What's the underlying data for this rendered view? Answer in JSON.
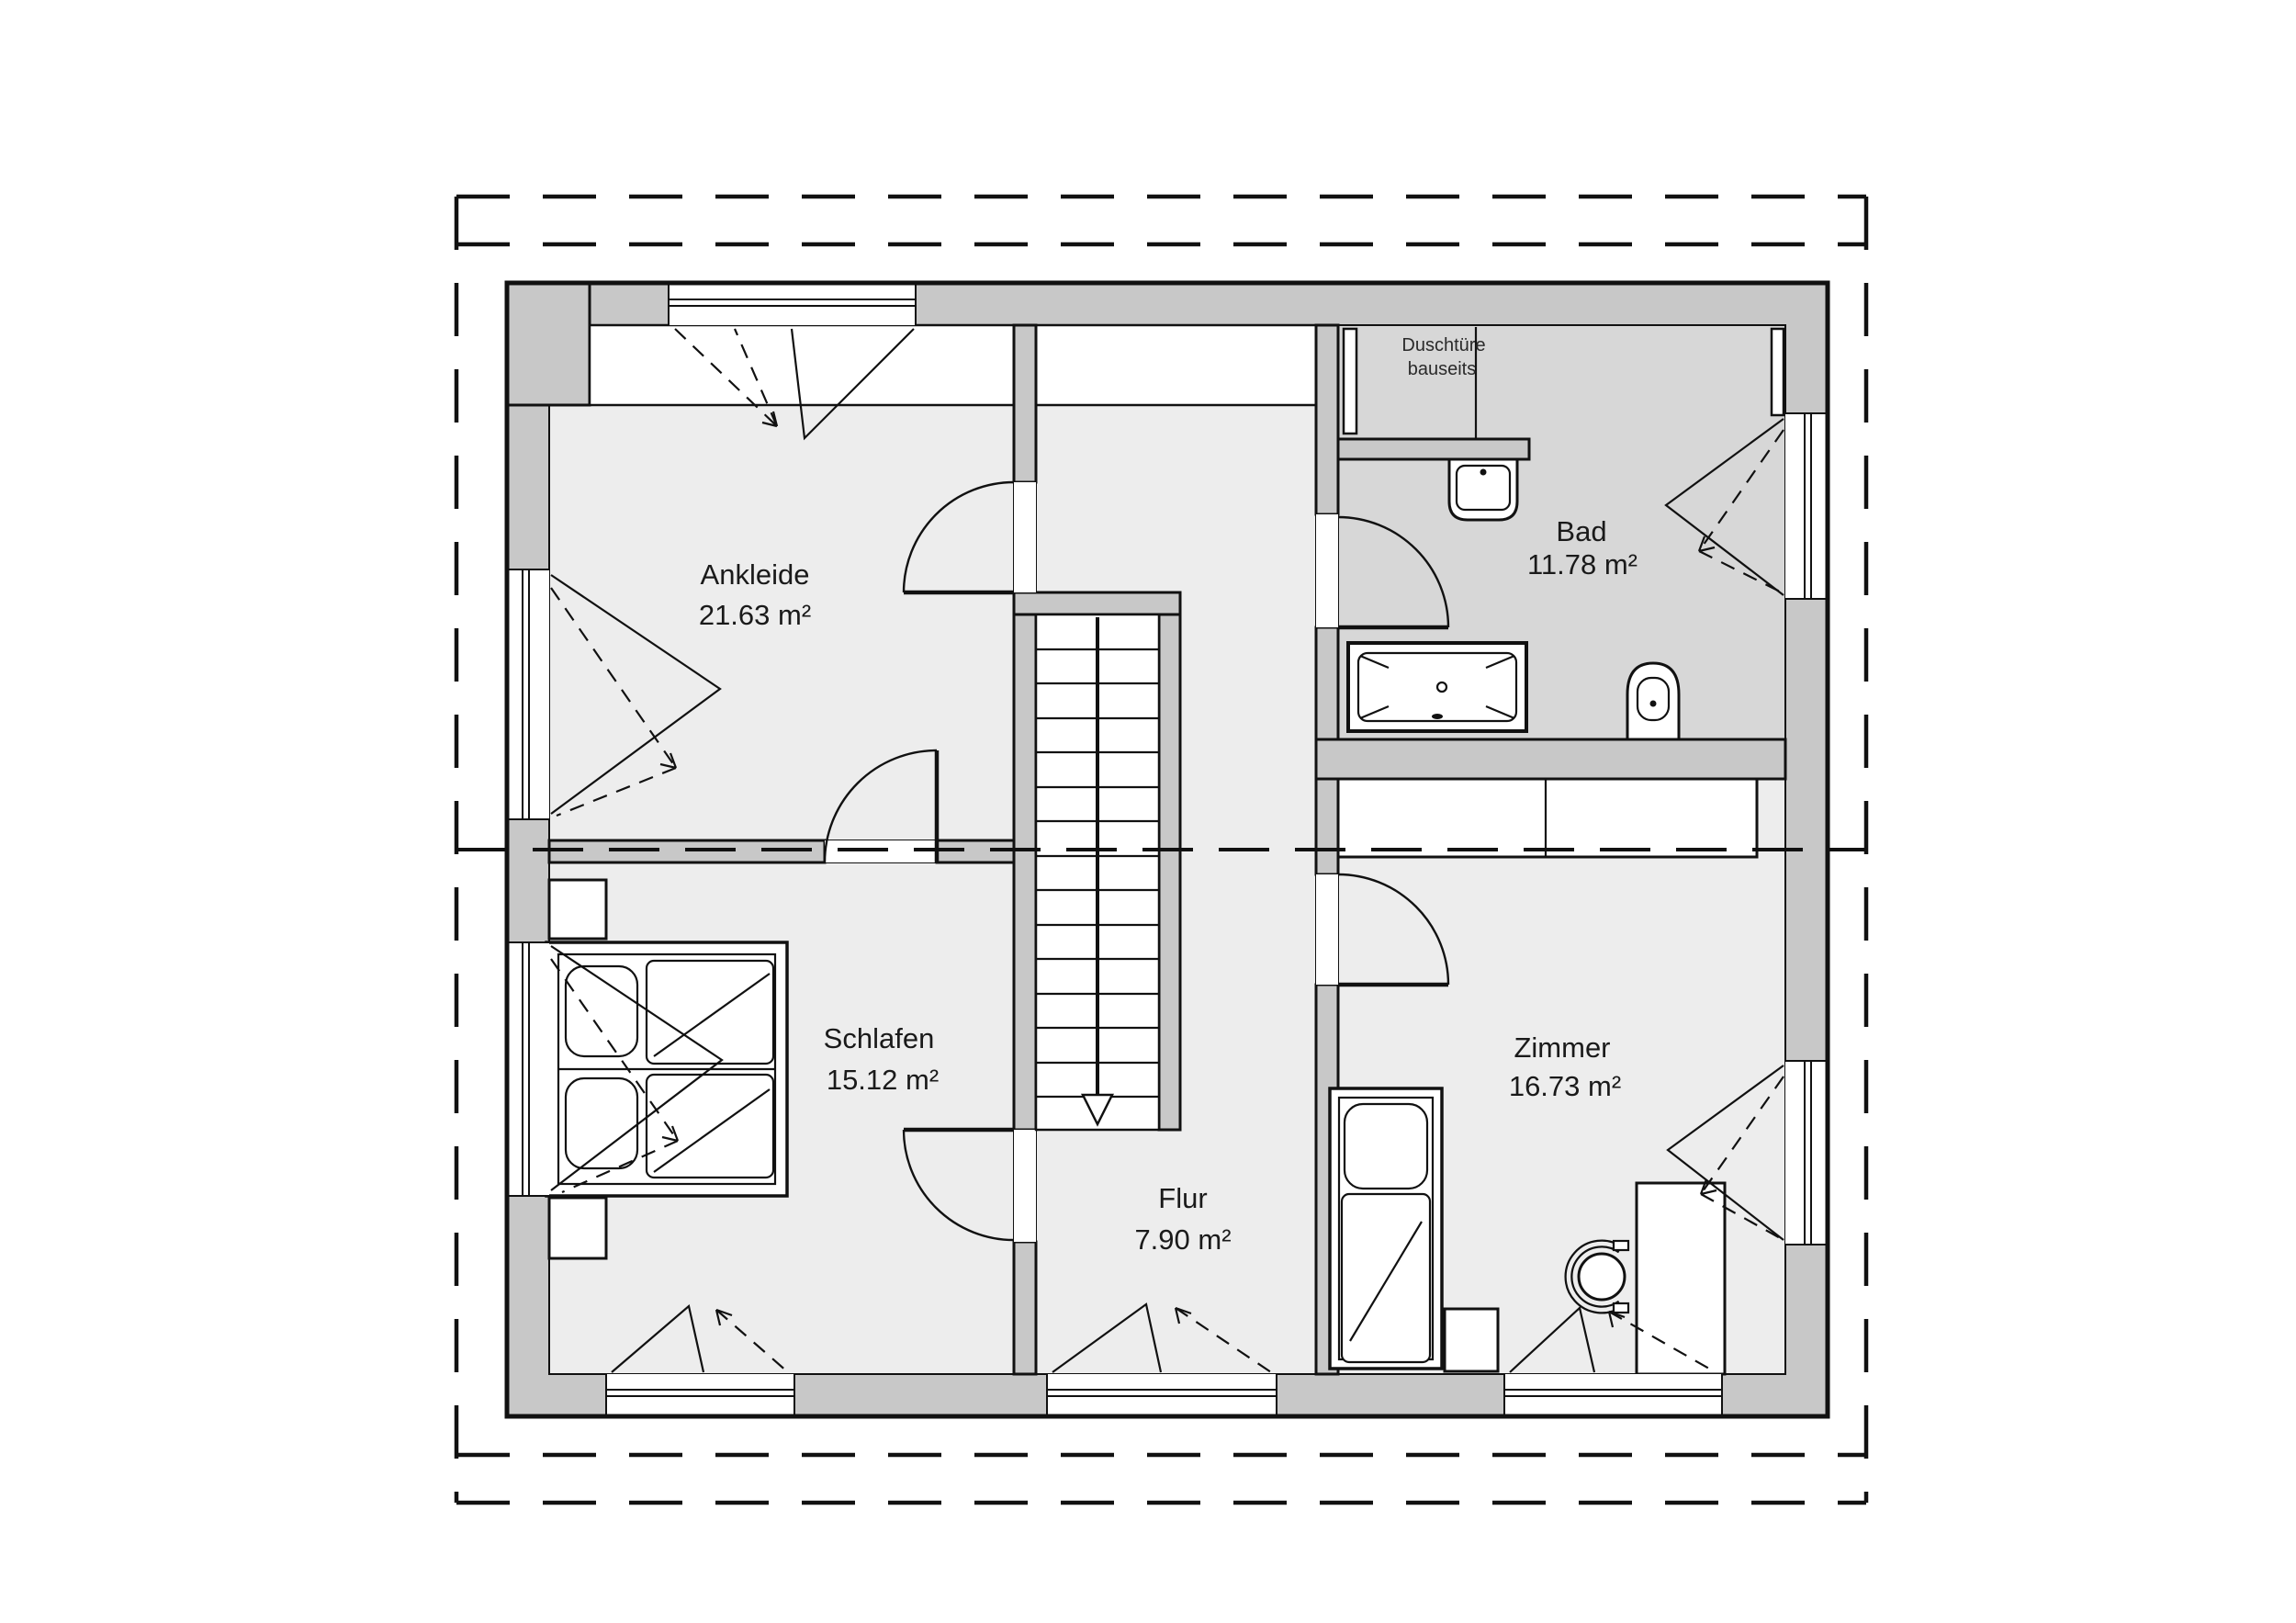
{
  "rooms": {
    "ankleide": {
      "name": "Ankleide",
      "area": "21.63 m²"
    },
    "bad": {
      "name": "Bad",
      "area": "11.78 m²"
    },
    "schlafen": {
      "name": "Schlafen",
      "area": "15.12 m²"
    },
    "zimmer": {
      "name": "Zimmer",
      "area": "16.73 m²"
    },
    "flur": {
      "name": "Flur",
      "area": "7.90 m²"
    }
  },
  "notes": {
    "shower_line1": "Duschtüre",
    "shower_line2": "bauseits"
  },
  "colors": {
    "wall-color": "#c8c8c8",
    "bad-floor": "#d7d7d7",
    "room-floor": "#ededed",
    "line-color": "#111111",
    "page-bg": "#ffffff"
  }
}
